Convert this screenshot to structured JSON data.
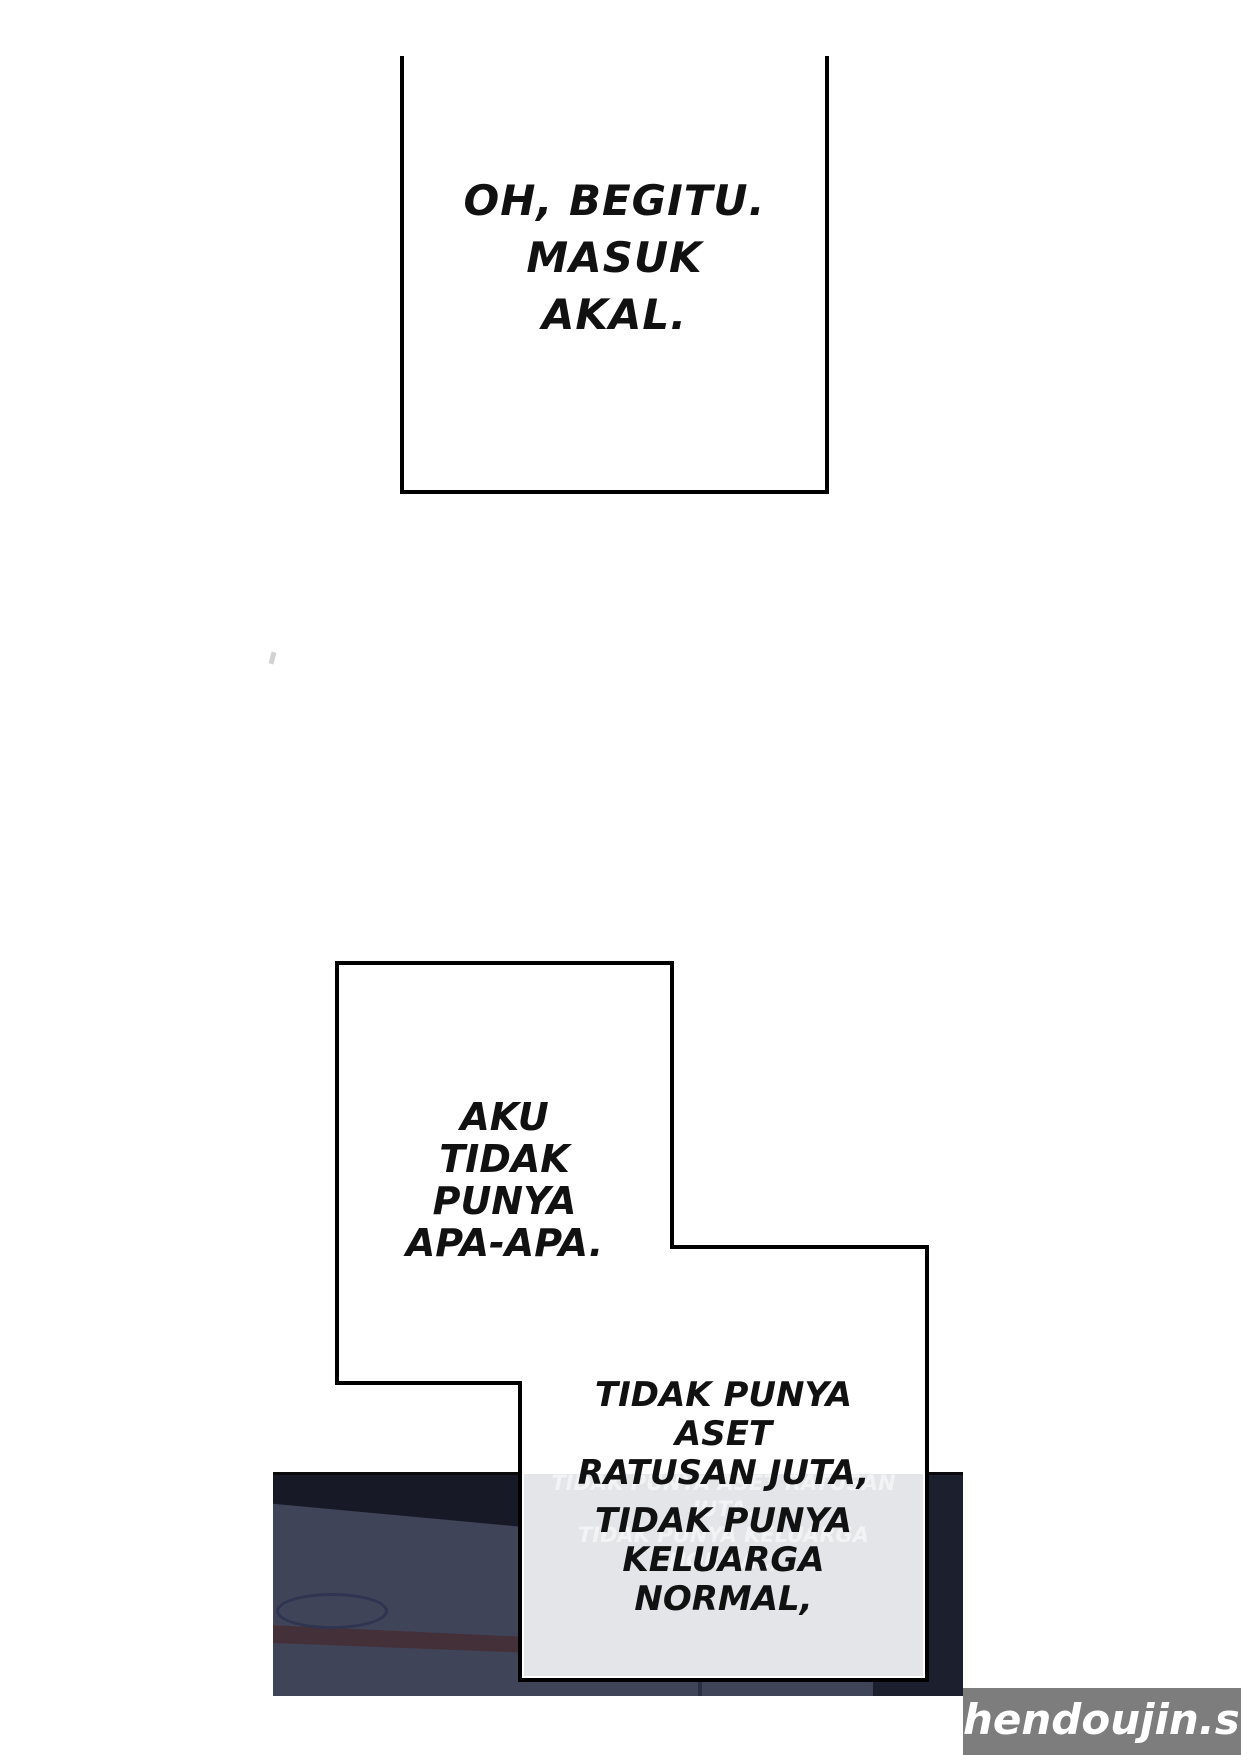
{
  "comic": {
    "panel1": {
      "lines": [
        "OH, BEGITU.",
        "MASUK",
        "AKAL."
      ]
    },
    "panel2": {
      "lines": [
        "AKU",
        "TIDAK",
        "PUNYA",
        "APA-APA."
      ]
    },
    "caption": {
      "lines": [
        "TIDAK PUNYA",
        "ASET",
        "RATUSAN JUTA,",
        "TIDAK PUNYA",
        "KELUARGA",
        "NORMAL,"
      ],
      "ghost_lines": [
        "TIDAK PUNYA ASET RATUSAN JUTA,",
        "TIDAK PUNYA KELUARGA NORMAL,"
      ]
    },
    "watermark": {
      "text": "hendoujin.site",
      "bg_color": "#7d7d7d",
      "text_color": "#ffffff"
    },
    "colors": {
      "ink": "#111111",
      "page_bg": "#ffffff",
      "band_base": "#3f4459",
      "band_dark_top": "#171a26",
      "band_right_strip": "#1b1f2e",
      "band_stripe": "#443039",
      "band_ellipse_stroke": "#2f3450",
      "bubble_lower_bg": "#e3e5e8"
    }
  }
}
